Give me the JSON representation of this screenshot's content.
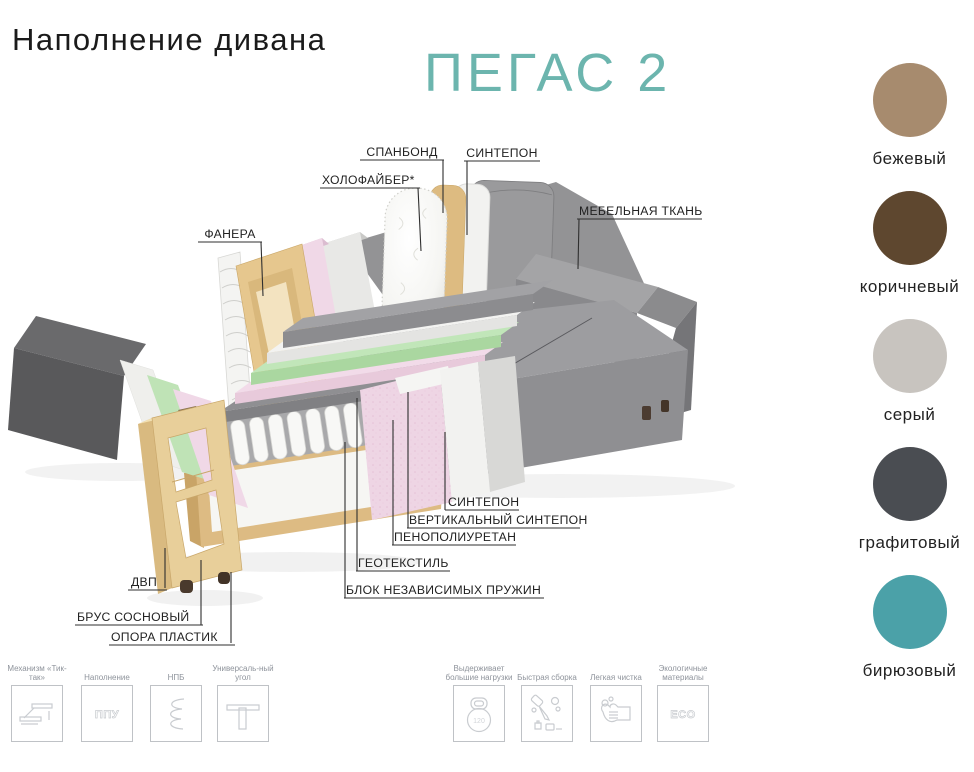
{
  "header": {
    "title": "Наполнение дивана",
    "product_name": "ПЕГАС 2",
    "accent_color": "#6cb5ae"
  },
  "diagram": {
    "labels": {
      "spanbond": "СПАНБОНД",
      "sintepon_top": "СИНТЕПОН",
      "holofiber": "ХОЛОФАЙБЕР*",
      "fanera": "ФАНЕРА",
      "fabric": "МЕБЕЛЬНАЯ ТКАНЬ",
      "sintepon_bottom": "СИНТЕПОН",
      "vertical_sintepon": "ВЕРТИКАЛЬНЫЙ СИНТЕПОН",
      "ppu": "ПЕНОПОЛИУРЕТАН",
      "geotextile": "ГЕОТЕКСТИЛЬ",
      "spring_block": "БЛОК НЕЗАВИСИМЫХ ПРУЖИН",
      "dvp": "ДВП",
      "pine_timber": "БРУС СОСНОВЫЙ",
      "plastic_support": "ОПОРА ПЛАСТИК"
    }
  },
  "swatches": [
    {
      "name": "бежевый",
      "hex": "#a78b6e"
    },
    {
      "name": "коричневый",
      "hex": "#5e472f"
    },
    {
      "name": "серый",
      "hex": "#c8c4bf"
    },
    {
      "name": "графитовый",
      "hex": "#4a4d52"
    },
    {
      "name": "бирюзовый",
      "hex": "#4ba1a8"
    }
  ],
  "features": [
    {
      "label": "Механизм «Тик-так»",
      "icon": "tik-tak-mechanism-icon"
    },
    {
      "label": "Наполнение",
      "icon": "ppu-icon",
      "icon_text": "ППУ"
    },
    {
      "label": "НПБ",
      "icon": "spring-icon"
    },
    {
      "label": "Универсаль-ный угол",
      "icon": "universal-corner-icon"
    },
    {
      "label": "Выдерживает большие нагрузки",
      "icon": "kettlebell-icon",
      "icon_text": "120"
    },
    {
      "label": "Быстрая сборка",
      "icon": "assembly-icon"
    },
    {
      "label": "Легкая чистка",
      "icon": "cleaning-icon"
    },
    {
      "label": "Экологичные материалы",
      "icon": "eco-icon",
      "icon_text": "ECO"
    }
  ]
}
